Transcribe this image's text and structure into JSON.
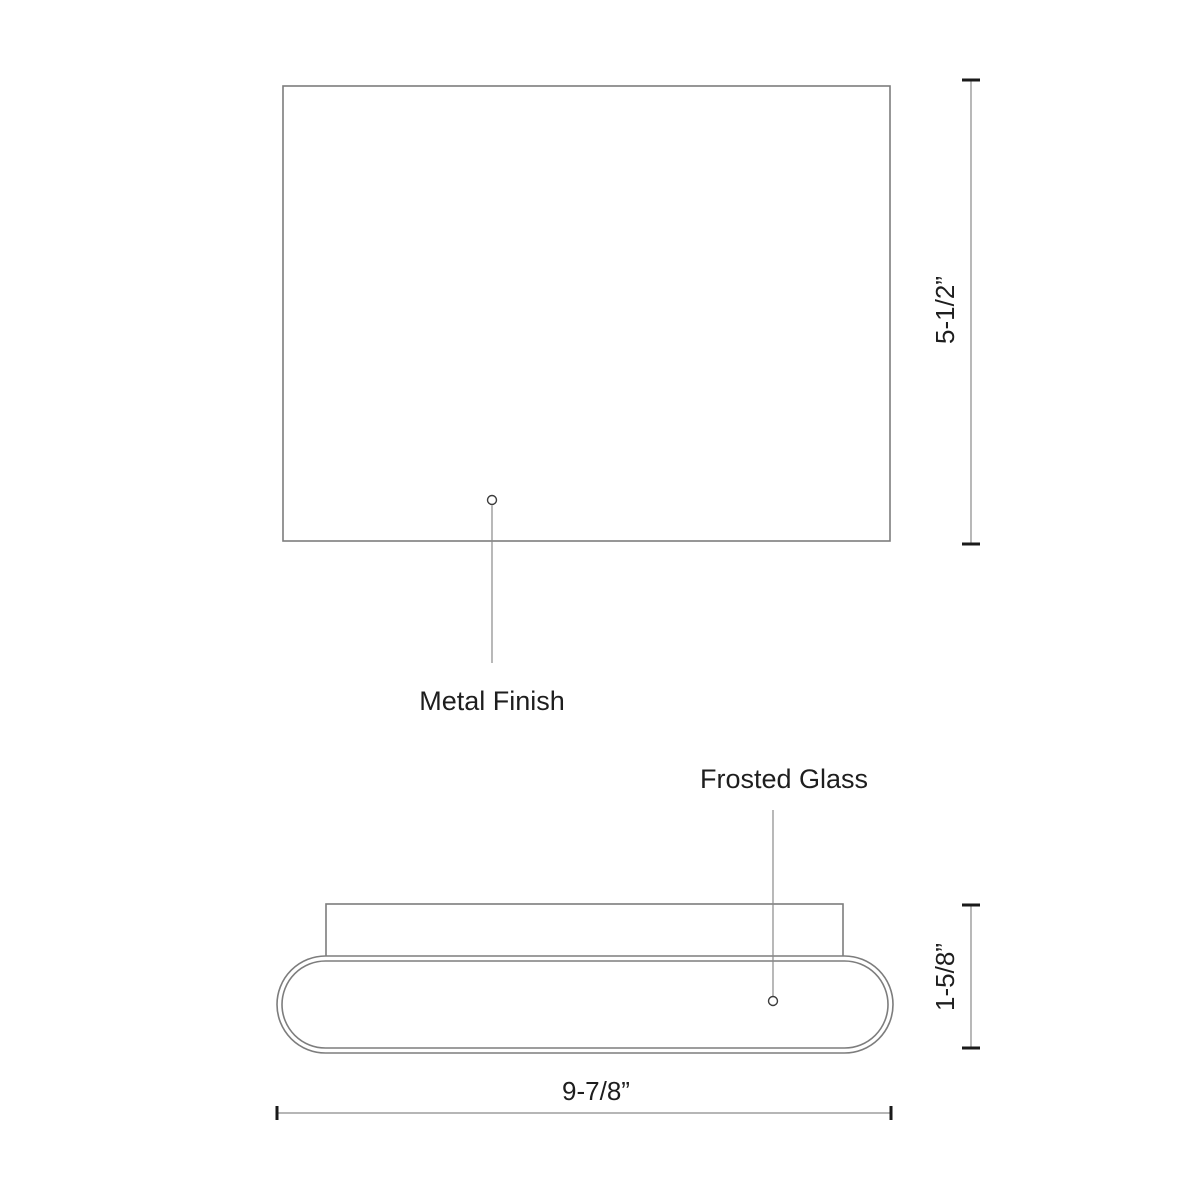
{
  "drawing": {
    "front_view": {
      "callout_label": "Metal Finish",
      "height_dimension": "5-1/2”"
    },
    "side_view": {
      "callout_label": "Frosted Glass",
      "height_dimension": "1-5/8”",
      "width_dimension": "9-7/8”"
    },
    "colors": {
      "background": "#ffffff",
      "outline": "#7d7d7d",
      "dimension_line": "#8a8a8a",
      "tick": "#1a1a1a",
      "text": "#1e1e1e"
    }
  }
}
